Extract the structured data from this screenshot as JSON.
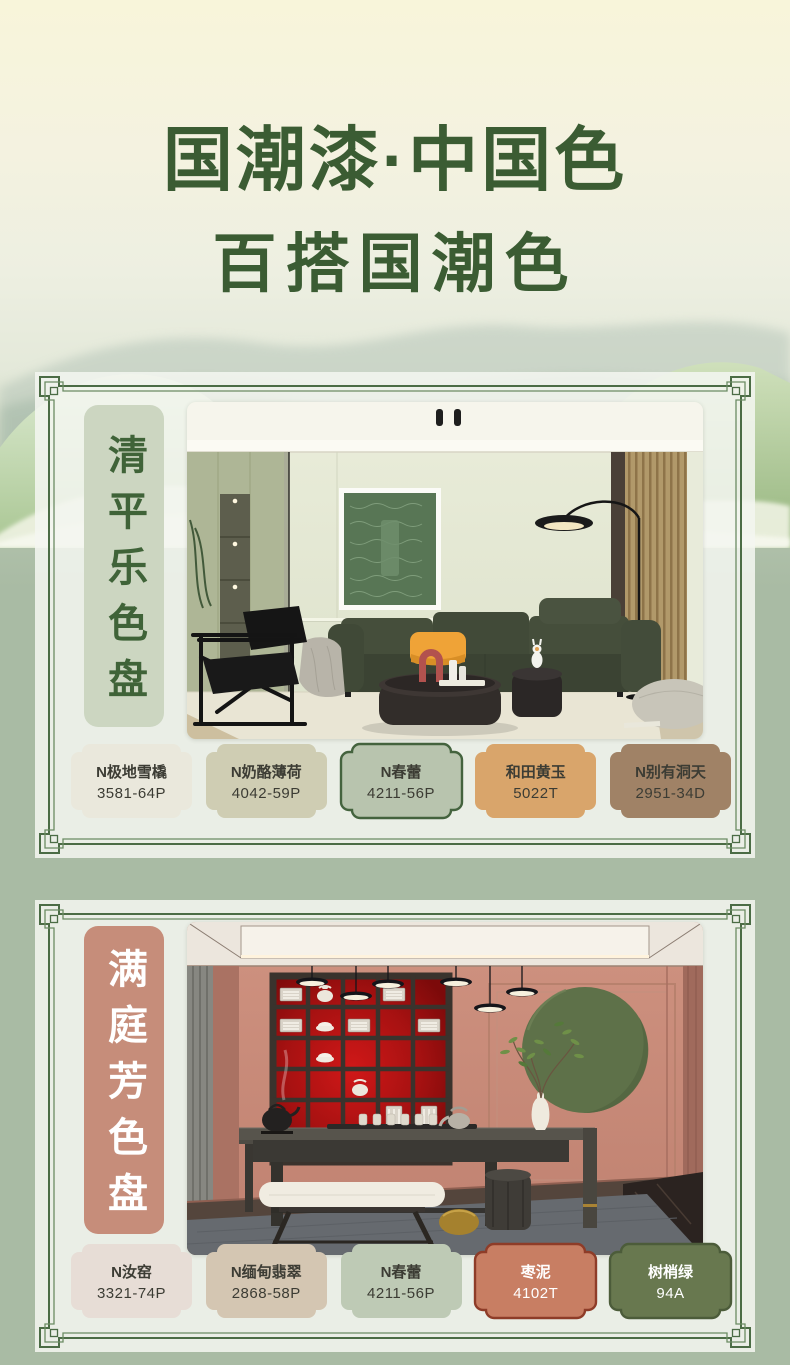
{
  "title": {
    "line1": "国潮漆·中国色",
    "line2": "百搭国潮色",
    "color": "#3b5c33"
  },
  "colors": {
    "frame_outer": "#4b6c45",
    "frame_inner": "#6b8b63",
    "page_top": "#f8f5da",
    "page_green": "#a9bba4",
    "card_bg": "#f2f4ed"
  },
  "cards": [
    {
      "label": "清平乐色盘",
      "label_bg": "#ccd6c1",
      "label_color": "#3f6338",
      "photo_name": "living-room-green-sofa",
      "swatches": [
        {
          "name": "N极地雪橇",
          "code": "3581-64P",
          "bg": "#eae8dc",
          "text_color": "#3c3c34",
          "border_color": ""
        },
        {
          "name": "N奶酪薄荷",
          "code": "4042-59P",
          "bg": "#cfcdb3",
          "text_color": "#3c3c34",
          "border_color": ""
        },
        {
          "name": "N春蕾",
          "code": "4211-56P",
          "bg": "#b8c4ae",
          "text_color": "#3c3c34",
          "border_color": "#44633e"
        },
        {
          "name": "和田黄玉",
          "code": "5022T",
          "bg": "#d9a56b",
          "text_color": "#3c3c34",
          "border_color": ""
        },
        {
          "name": "N别有洞天",
          "code": "2951-34D",
          "bg": "#a08266",
          "text_color": "#3c3c34",
          "border_color": ""
        }
      ]
    },
    {
      "label": "满庭芳色盘",
      "label_bg": "#c68d7a",
      "label_color": "#ffffff",
      "photo_name": "tea-room-red-shelf",
      "swatches": [
        {
          "name": "N汝窑",
          "code": "3321-74P",
          "bg": "#e7ddd6",
          "text_color": "#3c3c34",
          "border_color": ""
        },
        {
          "name": "N缅甸翡翠",
          "code": "2868-58P",
          "bg": "#d4c6b2",
          "text_color": "#3c3c34",
          "border_color": ""
        },
        {
          "name": "N春蕾",
          "code": "4211-56P",
          "bg": "#becab5",
          "text_color": "#3c3c34",
          "border_color": ""
        },
        {
          "name": "枣泥",
          "code": "4102T",
          "bg": "#c87e63",
          "text_color": "#ffffff",
          "border_color": "#8e3c28"
        },
        {
          "name": "树梢绿",
          "code": "94A",
          "bg": "#68784f",
          "text_color": "#ffffff",
          "border_color": "#4c5c3a"
        }
      ]
    }
  ]
}
